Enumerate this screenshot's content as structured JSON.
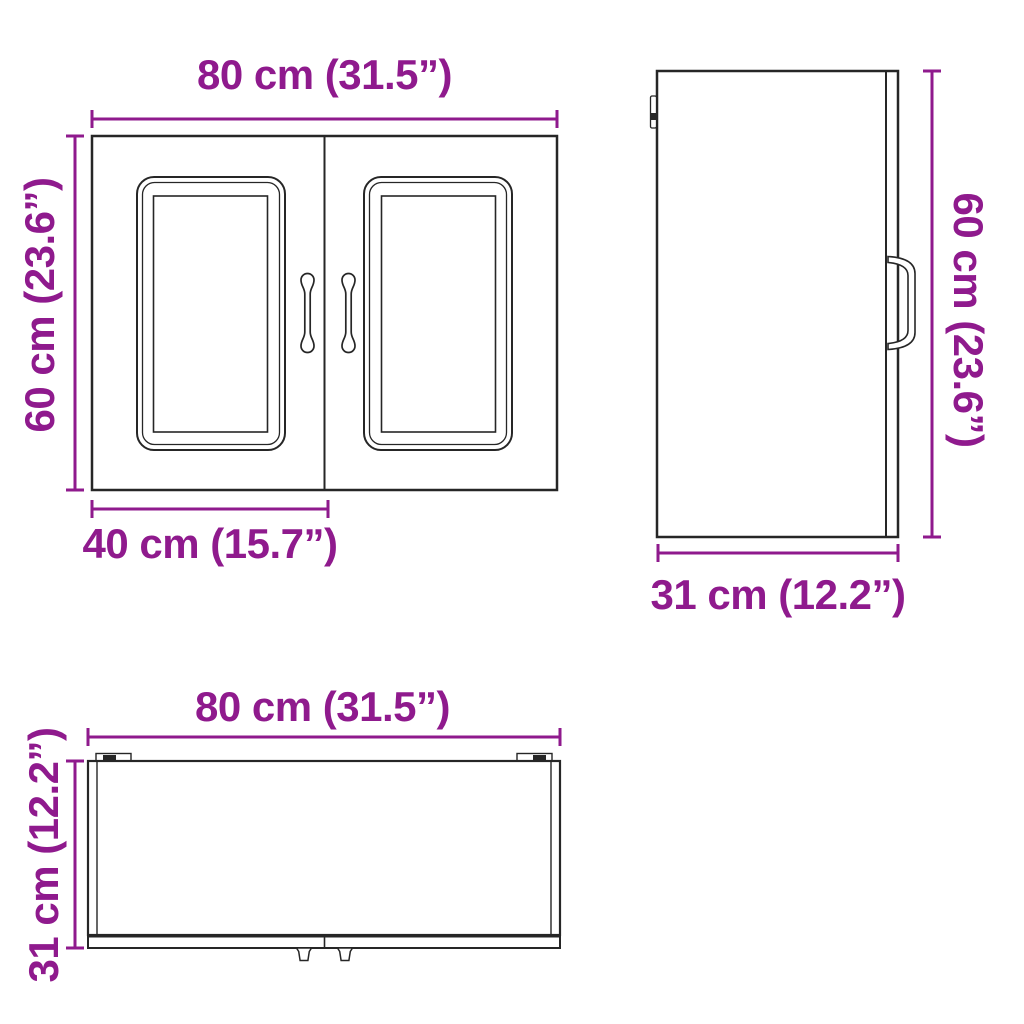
{
  "colors": {
    "accent": "#8F1A8D",
    "line": "#262626"
  },
  "front_view": {
    "width_label": "80 cm (31.5”)",
    "height_label": "60 cm (23.6”)",
    "door_width_label": "40 cm (15.7”)"
  },
  "side_view": {
    "height_label": "60 cm (23.6”)",
    "depth_label": "31 cm (12.2”)"
  },
  "top_view": {
    "width_label": "80 cm (31.5”)",
    "depth_label": "31 cm (12.2”)"
  }
}
